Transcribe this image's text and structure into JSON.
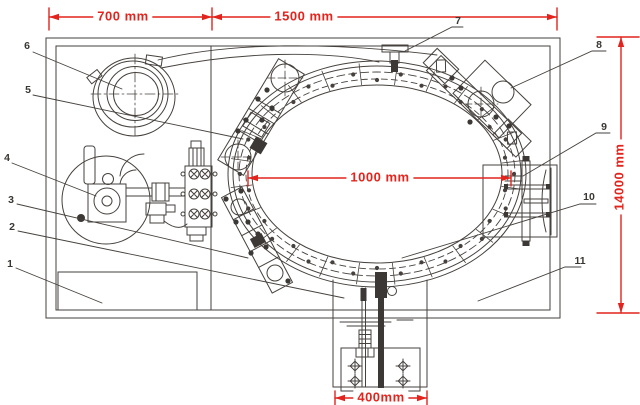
{
  "canvas": {
    "width": 640,
    "height": 405
  },
  "colors": {
    "dimension_red": "#e2241d",
    "line_dark": "#46413d"
  },
  "dimensions": {
    "left_width": "700 mm",
    "right_width": "1500 mm",
    "ring_diameter": "1000 mm",
    "total_height": "14000 mm",
    "base_width": "400mm"
  },
  "callouts": [
    "1",
    "2",
    "3",
    "4",
    "5",
    "6",
    "7",
    "8",
    "9",
    "10",
    "11"
  ]
}
